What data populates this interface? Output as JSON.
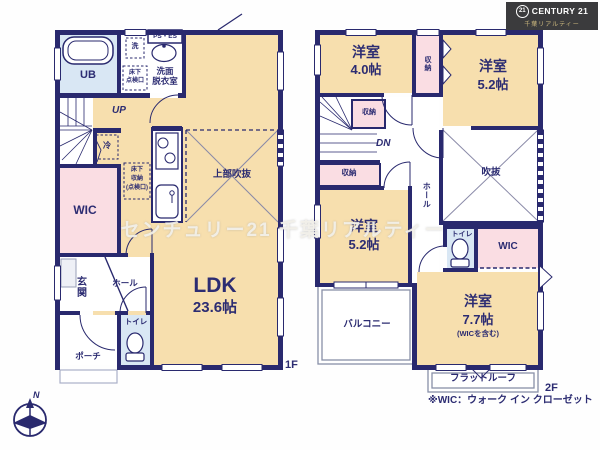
{
  "brand": {
    "badge": "21",
    "name": "CENTURY 21",
    "subtitle": "千葉リアルティー"
  },
  "watermark": "センチュリー21 千葉リアルティー",
  "floor1": {
    "floor_label": "1F",
    "ldk_name": "LDK",
    "ldk_size": "23.6帖",
    "void_label": "上部吹抜",
    "bath": "UB",
    "washer": "洗",
    "ps_es": "PS・ES",
    "washroom_line1": "洗面",
    "washroom_line2": "脱衣室",
    "hatch_line1": "床下",
    "hatch_line2": "点検口",
    "up": "UP",
    "fridge": "冷",
    "floor_storage_line1": "床下",
    "floor_storage_line2": "収納",
    "floor_storage_line3": "(点検口)",
    "wic": "WIC",
    "genkan": "玄関",
    "hall": "ホール",
    "toilet": "トイレ",
    "porch": "ポーチ"
  },
  "floor2": {
    "floor_label": "2F",
    "room_nw_name": "洋室",
    "room_nw_size": "4.0帖",
    "closet_top": "収納",
    "room_ne_name": "洋室",
    "room_ne_size": "5.2帖",
    "closet_mid": "収納",
    "dn": "DN",
    "closet_low": "収納",
    "hall": "ホール",
    "void_label": "吹抜",
    "toilet": "トイレ",
    "wic": "WIC",
    "room_w_name": "洋室",
    "room_w_size": "5.2帖",
    "balcony": "バルコニー",
    "room_se_name": "洋室",
    "room_se_size": "7.7帖",
    "room_se_note": "(WICを含む)",
    "flat_roof": "フラットルーフ"
  },
  "footnote": "※WIC：ウォーク イン クローゼット",
  "compass": {
    "north": "N"
  }
}
